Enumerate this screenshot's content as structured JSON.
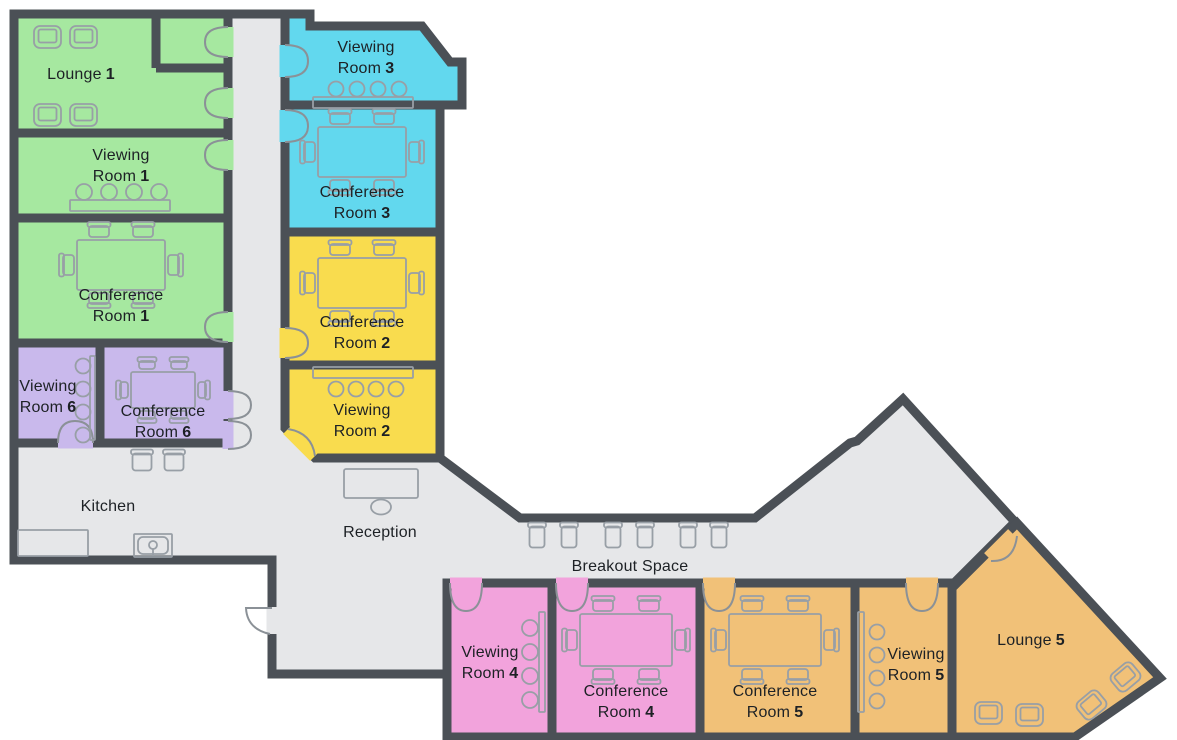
{
  "plan": {
    "type": "office-floor-plan"
  },
  "colors": {
    "wall": "#4b5056",
    "floor": "#e6e7e9",
    "furniture_outline": "#989fa6",
    "door_symbol": "#8b9197",
    "label_text": "#1d2125",
    "green": "#a6e8a0",
    "purple": "#c9b9ec",
    "cyan": "#62d8ee",
    "yellow": "#f9dc4e",
    "pink": "#f2a3dc",
    "orange": "#f1c178"
  },
  "rooms": [
    {
      "id": "lounge-1",
      "line1": "Lounge",
      "number": "1",
      "color_key": "green"
    },
    {
      "id": "viewing-room-1",
      "line1": "Viewing",
      "line2": "Room",
      "number": "1",
      "color_key": "green"
    },
    {
      "id": "conference-room-1",
      "line1": "Conference",
      "line2": "Room",
      "number": "1",
      "color_key": "green"
    },
    {
      "id": "viewing-room-6",
      "line1": "Viewing",
      "line2": "Room",
      "number": "6",
      "color_key": "purple"
    },
    {
      "id": "conference-room-6",
      "line1": "Conference",
      "line2": "Room",
      "number": "6",
      "color_key": "purple"
    },
    {
      "id": "viewing-room-3",
      "line1": "Viewing",
      "line2": "Room",
      "number": "3",
      "color_key": "cyan"
    },
    {
      "id": "conference-room-3",
      "line1": "Conference",
      "line2": "Room",
      "number": "3",
      "color_key": "cyan"
    },
    {
      "id": "conference-room-2",
      "line1": "Conference",
      "line2": "Room",
      "number": "2",
      "color_key": "yellow"
    },
    {
      "id": "viewing-room-2",
      "line1": "Viewing",
      "line2": "Room",
      "number": "2",
      "color_key": "yellow"
    },
    {
      "id": "viewing-room-4",
      "line1": "Viewing",
      "line2": "Room",
      "number": "4",
      "color_key": "pink"
    },
    {
      "id": "conference-room-4",
      "line1": "Conference",
      "line2": "Room",
      "number": "4",
      "color_key": "pink"
    },
    {
      "id": "conference-room-5",
      "line1": "Conference",
      "line2": "Room",
      "number": "5",
      "color_key": "orange"
    },
    {
      "id": "viewing-room-5",
      "line1": "Viewing",
      "line2": "Room",
      "number": "5",
      "color_key": "orange"
    },
    {
      "id": "lounge-5",
      "line1": "Lounge",
      "number": "5",
      "color_key": "orange"
    }
  ],
  "areas": [
    {
      "id": "kitchen",
      "label": "Kitchen"
    },
    {
      "id": "reception",
      "label": "Reception"
    },
    {
      "id": "breakout-space",
      "label": "Breakout Space"
    }
  ],
  "icons": {
    "conference-set": "rectangle table outline with six chairs",
    "viewing-seats": "row of four circles",
    "media-bench": "thin rectangle",
    "armchair": "nested rounded squares",
    "chair": "small rounded square with back bar",
    "reception-desk": "rectangle with round stool",
    "kitchen-counter": "rectangle",
    "kitchen-sink": "basin with tap",
    "door": "quarter-arc swing symbol"
  }
}
